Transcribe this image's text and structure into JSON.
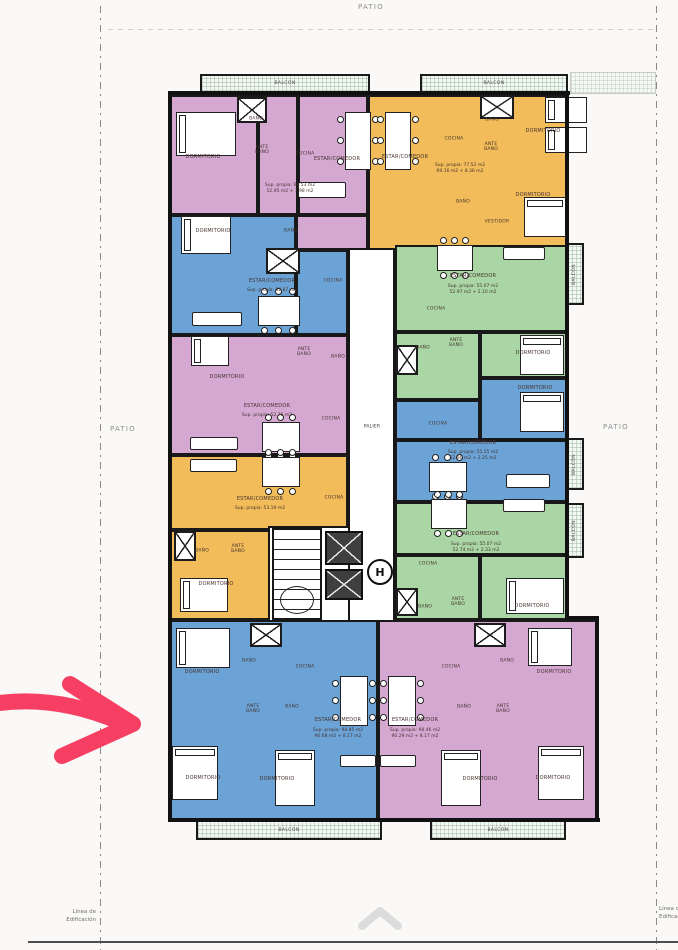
{
  "page": {
    "patio_top": "PATIO",
    "patio_left": "PATIO",
    "patio_right": "PATIO",
    "linea_l1": "Línea de",
    "linea_l2": "Edificación"
  },
  "palette": {
    "pink": "#d5a8d2",
    "blue": "#6ba3d6",
    "orange": "#f2bc5a",
    "green": "#a9d6a4",
    "wall": "#111111",
    "arrow": "#f73e63",
    "chevron": "#dcdcdc"
  },
  "plan": {
    "rooms": [
      {
        "x": 170,
        "y": 95,
        "w": 88,
        "h": 120,
        "c": "pink"
      },
      {
        "x": 258,
        "y": 95,
        "w": 40,
        "h": 120,
        "c": "pink"
      },
      {
        "x": 298,
        "y": 95,
        "w": 70,
        "h": 120,
        "c": "pink"
      },
      {
        "x": 296,
        "y": 215,
        "w": 72,
        "h": 35,
        "c": "pink"
      },
      {
        "x": 170,
        "y": 215,
        "w": 126,
        "h": 120,
        "c": "blue"
      },
      {
        "x": 296,
        "y": 250,
        "w": 52,
        "h": 85,
        "c": "blue"
      },
      {
        "x": 170,
        "y": 335,
        "w": 178,
        "h": 120,
        "c": "pink"
      },
      {
        "x": 170,
        "y": 455,
        "w": 178,
        "h": 75,
        "c": "orange"
      },
      {
        "x": 170,
        "y": 530,
        "w": 100,
        "h": 90,
        "c": "orange"
      },
      {
        "x": 368,
        "y": 95,
        "w": 200,
        "h": 155,
        "c": "orange"
      },
      {
        "x": 395,
        "y": 245,
        "w": 173,
        "h": 87,
        "c": "green"
      },
      {
        "x": 395,
        "y": 332,
        "w": 85,
        "h": 68,
        "c": "green"
      },
      {
        "x": 480,
        "y": 332,
        "w": 88,
        "h": 46,
        "c": "green"
      },
      {
        "x": 480,
        "y": 378,
        "w": 88,
        "h": 62,
        "c": "blue"
      },
      {
        "x": 395,
        "y": 400,
        "w": 85,
        "h": 40,
        "c": "blue"
      },
      {
        "x": 395,
        "y": 440,
        "w": 173,
        "h": 62,
        "c": "blue"
      },
      {
        "x": 395,
        "y": 502,
        "w": 173,
        "h": 53,
        "c": "green"
      },
      {
        "x": 395,
        "y": 555,
        "w": 85,
        "h": 65,
        "c": "green"
      },
      {
        "x": 480,
        "y": 555,
        "w": 88,
        "h": 65,
        "c": "green"
      },
      {
        "x": 170,
        "y": 620,
        "w": 208,
        "h": 200,
        "c": "blue"
      },
      {
        "x": 378,
        "y": 620,
        "w": 220,
        "h": 200,
        "c": "pink"
      }
    ],
    "palier": {
      "x": 348,
      "y": 248,
      "w": 47,
      "h": 374
    },
    "stair_hall": {
      "x": 268,
      "y": 526,
      "w": 82,
      "h": 96
    },
    "stairs": {
      "x": 272,
      "y": 528,
      "w": 50,
      "h": 92
    },
    "oval": {
      "x": 280,
      "y": 586,
      "w": 34,
      "h": 28
    },
    "lifts": [
      {
        "x": 325,
        "y": 531,
        "w": 38,
        "h": 34
      },
      {
        "x": 325,
        "y": 569,
        "w": 38,
        "h": 31
      }
    ],
    "lift_symbol": {
      "x": 367,
      "y": 559,
      "w": 26,
      "h": 26,
      "glyph": "H"
    },
    "balconies": [
      {
        "x": 200,
        "y": 74,
        "w": 170,
        "h": 19,
        "label": "BALCÓN"
      },
      {
        "x": 420,
        "y": 74,
        "w": 148,
        "h": 19,
        "label": "BALCÓN"
      },
      {
        "x": 570,
        "y": 72,
        "w": 86,
        "h": 22,
        "faint": true
      },
      {
        "x": 196,
        "y": 820,
        "w": 186,
        "h": 20,
        "label": "BALCÓN"
      },
      {
        "x": 430,
        "y": 820,
        "w": 136,
        "h": 20,
        "label": "BALCÓN"
      },
      {
        "x": 566,
        "y": 243,
        "w": 18,
        "h": 62,
        "label": "BALCÓN",
        "vert": true
      },
      {
        "x": 566,
        "y": 438,
        "w": 18,
        "h": 52,
        "label": "BALCÓN",
        "vert": true
      },
      {
        "x": 566,
        "y": 503,
        "w": 18,
        "h": 55,
        "label": "BALCÓN",
        "vert": true
      }
    ],
    "shafts": [
      {
        "x": 237,
        "y": 97,
        "w": 30,
        "h": 26
      },
      {
        "x": 480,
        "y": 95,
        "w": 34,
        "h": 24
      },
      {
        "x": 266,
        "y": 248,
        "w": 34,
        "h": 26
      },
      {
        "x": 396,
        "y": 345,
        "w": 22,
        "h": 30
      },
      {
        "x": 174,
        "y": 531,
        "w": 22,
        "h": 30
      },
      {
        "x": 396,
        "y": 588,
        "w": 22,
        "h": 28
      },
      {
        "x": 250,
        "y": 623,
        "w": 32,
        "h": 24
      },
      {
        "x": 474,
        "y": 623,
        "w": 32,
        "h": 24
      }
    ],
    "outer_walls": [
      [
        168,
        91,
        402,
        4
      ],
      [
        168,
        91,
        4,
        731
      ],
      [
        565,
        91,
        4,
        529
      ],
      [
        595,
        616,
        4,
        206
      ],
      [
        565,
        616,
        34,
        4
      ],
      [
        168,
        818,
        432,
        4
      ]
    ],
    "beds": [
      {
        "x": 176,
        "y": 112,
        "w": 60,
        "h": 44,
        "o": "h"
      },
      {
        "x": 181,
        "y": 216,
        "w": 50,
        "h": 38,
        "o": "h"
      },
      {
        "x": 191,
        "y": 336,
        "w": 38,
        "h": 30,
        "o": "h"
      },
      {
        "x": 545,
        "y": 97,
        "w": 42,
        "h": 26,
        "o": "h"
      },
      {
        "x": 545,
        "y": 127,
        "w": 42,
        "h": 26,
        "o": "h"
      },
      {
        "x": 524,
        "y": 197,
        "w": 42,
        "h": 40,
        "o": "v"
      },
      {
        "x": 520,
        "y": 335,
        "w": 44,
        "h": 40,
        "o": "v"
      },
      {
        "x": 520,
        "y": 392,
        "w": 44,
        "h": 40,
        "o": "v"
      },
      {
        "x": 506,
        "y": 578,
        "w": 58,
        "h": 36,
        "o": "h"
      },
      {
        "x": 180,
        "y": 578,
        "w": 48,
        "h": 34,
        "o": "h"
      },
      {
        "x": 176,
        "y": 628,
        "w": 54,
        "h": 40,
        "o": "h"
      },
      {
        "x": 172,
        "y": 746,
        "w": 46,
        "h": 54,
        "o": "v"
      },
      {
        "x": 275,
        "y": 750,
        "w": 40,
        "h": 56,
        "o": "v"
      },
      {
        "x": 528,
        "y": 628,
        "w": 44,
        "h": 38,
        "o": "h"
      },
      {
        "x": 538,
        "y": 746,
        "w": 46,
        "h": 54,
        "o": "v"
      },
      {
        "x": 441,
        "y": 750,
        "w": 40,
        "h": 56,
        "o": "v"
      }
    ],
    "tables": [
      {
        "x": 345,
        "y": 112,
        "w": 26,
        "h": 58,
        "o": "v"
      },
      {
        "x": 385,
        "y": 112,
        "w": 26,
        "h": 58,
        "o": "v"
      },
      {
        "x": 258,
        "y": 296,
        "w": 42,
        "h": 30,
        "o": "h"
      },
      {
        "x": 262,
        "y": 422,
        "w": 38,
        "h": 30,
        "o": "h"
      },
      {
        "x": 262,
        "y": 457,
        "w": 38,
        "h": 30,
        "o": "h"
      },
      {
        "x": 437,
        "y": 245,
        "w": 36,
        "h": 26,
        "o": "h"
      },
      {
        "x": 429,
        "y": 462,
        "w": 38,
        "h": 30,
        "o": "h"
      },
      {
        "x": 431,
        "y": 499,
        "w": 36,
        "h": 30,
        "o": "h"
      },
      {
        "x": 340,
        "y": 676,
        "w": 28,
        "h": 50,
        "o": "v"
      },
      {
        "x": 388,
        "y": 676,
        "w": 28,
        "h": 50,
        "o": "v"
      }
    ],
    "sofas": [
      {
        "x": 298,
        "y": 182,
        "w": 48,
        "h": 16
      },
      {
        "x": 192,
        "y": 312,
        "w": 50,
        "h": 14
      },
      {
        "x": 190,
        "y": 437,
        "w": 48,
        "h": 13
      },
      {
        "x": 190,
        "y": 459,
        "w": 47,
        "h": 13
      },
      {
        "x": 503,
        "y": 247,
        "w": 42,
        "h": 13
      },
      {
        "x": 506,
        "y": 474,
        "w": 44,
        "h": 14
      },
      {
        "x": 503,
        "y": 499,
        "w": 42,
        "h": 13
      },
      {
        "x": 340,
        "y": 755,
        "w": 36,
        "h": 12
      },
      {
        "x": 380,
        "y": 755,
        "w": 36,
        "h": 12
      }
    ],
    "labels": [
      {
        "t": "DORMITORIO",
        "x": 203,
        "y": 158
      },
      {
        "t": "BAÑO",
        "x": 256,
        "y": 119,
        "s": 4.5
      },
      {
        "t": "ANTE BAÑO",
        "x": 262,
        "y": 150,
        "w": 22,
        "s": 4.5
      },
      {
        "t": "COCINA",
        "x": 305,
        "y": 154,
        "s": 4.5
      },
      {
        "t": "ESTAR/COMEDOR",
        "x": 337,
        "y": 160
      },
      {
        "t": "COCINA",
        "x": 454,
        "y": 139,
        "s": 4.5
      },
      {
        "t": "ESTAR/COMEDOR",
        "x": 405,
        "y": 158
      },
      {
        "t": "DORMITORIO",
        "x": 543,
        "y": 132
      },
      {
        "t": "BAÑO",
        "x": 492,
        "y": 120,
        "s": 4.5
      },
      {
        "t": "ANTE BAÑO",
        "x": 491,
        "y": 147,
        "w": 22,
        "s": 4.5
      },
      {
        "t": "BAÑO",
        "x": 463,
        "y": 202,
        "s": 4.5
      },
      {
        "t": "VESTIDOR",
        "x": 497,
        "y": 222,
        "s": 4.5
      },
      {
        "t": "DORMITORIO",
        "x": 533,
        "y": 196
      },
      {
        "t": "DORMITORIO",
        "x": 213,
        "y": 232
      },
      {
        "t": "BAÑO",
        "x": 291,
        "y": 231,
        "s": 4.5
      },
      {
        "t": "ESTAR/COMEDOR",
        "x": 272,
        "y": 282
      },
      {
        "t": "COCINA",
        "x": 333,
        "y": 281,
        "s": 4.5
      },
      {
        "t": "ESTAR/COMEDOR",
        "x": 473,
        "y": 277
      },
      {
        "t": "COCINA",
        "x": 436,
        "y": 309,
        "s": 4.5
      },
      {
        "t": "BAÑO",
        "x": 423,
        "y": 348,
        "s": 4.5
      },
      {
        "t": "ANTE BAÑO",
        "x": 456,
        "y": 343,
        "w": 22,
        "s": 4.5
      },
      {
        "t": "DORMITORIO",
        "x": 533,
        "y": 354
      },
      {
        "t": "DORMITORIO",
        "x": 227,
        "y": 378
      },
      {
        "t": "ANTE BAÑO",
        "x": 304,
        "y": 352,
        "w": 22,
        "s": 4.5
      },
      {
        "t": "BAÑO",
        "x": 338,
        "y": 357,
        "s": 4.5
      },
      {
        "t": "ESTAR/COMEDOR",
        "x": 267,
        "y": 407
      },
      {
        "t": "COCINA",
        "x": 331,
        "y": 419,
        "s": 4.5
      },
      {
        "t": "DORMITORIO",
        "x": 535,
        "y": 389
      },
      {
        "t": "COCINA",
        "x": 438,
        "y": 424,
        "s": 4.5
      },
      {
        "t": "ESTAR/COMEDOR",
        "x": 473,
        "y": 444
      },
      {
        "t": "ESTAR/COMEDOR",
        "x": 260,
        "y": 500
      },
      {
        "t": "COCINA",
        "x": 334,
        "y": 498,
        "s": 4.5
      },
      {
        "t": "BAÑO",
        "x": 202,
        "y": 551,
        "s": 4.5
      },
      {
        "t": "ANTE BAÑO",
        "x": 238,
        "y": 549,
        "w": 22,
        "s": 4.5
      },
      {
        "t": "DORMITORIO",
        "x": 216,
        "y": 585
      },
      {
        "t": "ESTAR/COMEDOR",
        "x": 476,
        "y": 535
      },
      {
        "t": "COCINA",
        "x": 428,
        "y": 564,
        "s": 4.5
      },
      {
        "t": "BAÑO",
        "x": 425,
        "y": 607,
        "s": 4.5
      },
      {
        "t": "ANTE BAÑO",
        "x": 458,
        "y": 602,
        "w": 22,
        "s": 4.5
      },
      {
        "t": "DORMITORIO",
        "x": 532,
        "y": 607
      },
      {
        "t": "PALIER",
        "x": 372,
        "y": 427,
        "s": 4.5,
        "c": "#333333"
      },
      {
        "t": "DORMITORIO",
        "x": 202,
        "y": 673
      },
      {
        "t": "BAÑO",
        "x": 249,
        "y": 661,
        "s": 4.5
      },
      {
        "t": "COCINA",
        "x": 305,
        "y": 667,
        "s": 4.5
      },
      {
        "t": "ANTE BAÑO",
        "x": 253,
        "y": 709,
        "w": 22,
        "s": 4.5
      },
      {
        "t": "BAÑO",
        "x": 292,
        "y": 707,
        "s": 4.5
      },
      {
        "t": "ESTAR/COMEDOR",
        "x": 338,
        "y": 721
      },
      {
        "t": "DORMITORIO",
        "x": 203,
        "y": 779
      },
      {
        "t": "DORMITORIO",
        "x": 277,
        "y": 780
      },
      {
        "t": "COCINA",
        "x": 451,
        "y": 667,
        "s": 4.5
      },
      {
        "t": "BAÑO",
        "x": 507,
        "y": 661,
        "s": 4.5
      },
      {
        "t": "DORMITORIO",
        "x": 554,
        "y": 673
      },
      {
        "t": "ANTE BAÑO",
        "x": 503,
        "y": 709,
        "w": 22,
        "s": 4.5
      },
      {
        "t": "BAÑO",
        "x": 464,
        "y": 707,
        "s": 4.5
      },
      {
        "t": "ESTAR/COMEDOR",
        "x": 415,
        "y": 721
      },
      {
        "t": "DORMITORIO",
        "x": 480,
        "y": 780
      },
      {
        "t": "DORMITORIO",
        "x": 553,
        "y": 779
      }
    ],
    "sups": [
      {
        "x": 290,
        "y": 183,
        "l1": "Sup. propia: 60.53 m2",
        "l2": "52.95 m2 + 7.98 m2"
      },
      {
        "x": 460,
        "y": 163,
        "l1": "Sup. propia: 77.52 m2",
        "l2": "69.16 m2 + 8.36 m2"
      },
      {
        "x": 272,
        "y": 288,
        "l1": "Sup. propia: 52.87 m2"
      },
      {
        "x": 473,
        "y": 284,
        "l1": "Sup. propia: 55.07 m2",
        "l2": "52.97 m2 + 2.10 m2"
      },
      {
        "x": 267,
        "y": 413,
        "l1": "Sup. propia: 52.76 m2"
      },
      {
        "x": 473,
        "y": 450,
        "l1": "Sup. propia: 55.15 m2",
        "l2": "52.90 m2 + 2.25 m2"
      },
      {
        "x": 260,
        "y": 506,
        "l1": "Sup. propia: 53.19 m2"
      },
      {
        "x": 476,
        "y": 542,
        "l1": "Sup. propia: 55.07 m2",
        "l2": "52.74 m2 + 2.33 m2"
      },
      {
        "x": 338,
        "y": 728,
        "l1": "Sup. propia: 98.85 m2",
        "l2": "90.68 m2 + 8.17 m2"
      },
      {
        "x": 415,
        "y": 728,
        "l1": "Sup. propia: 98.46 m2",
        "l2": "90.29 m2 + 8.17 m2"
      }
    ]
  }
}
